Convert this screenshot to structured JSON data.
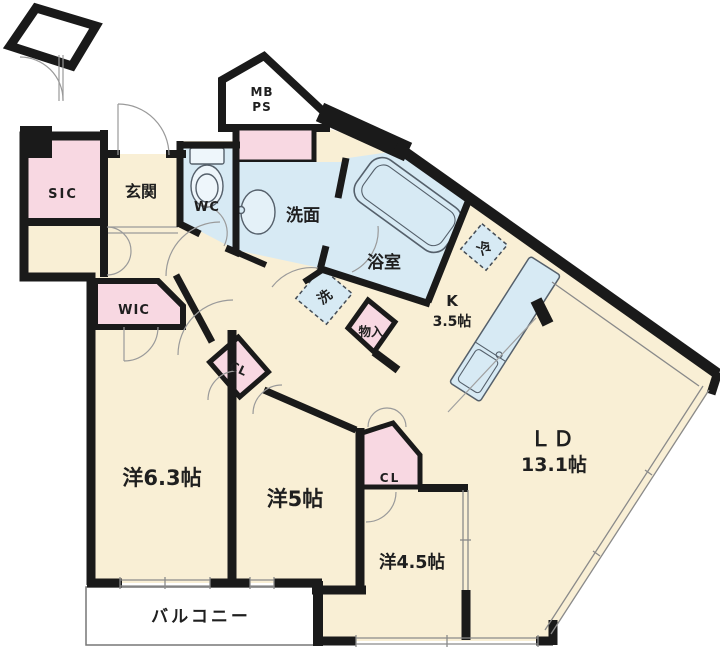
{
  "plan": {
    "type": "floor-plan",
    "rooms": {
      "sic": {
        "label": "SIC"
      },
      "genkan": {
        "label": "玄関"
      },
      "wc": {
        "label": "WC"
      },
      "mbps": {
        "label_line1": "MB",
        "label_line2": "PS"
      },
      "senmen": {
        "label": "洗面"
      },
      "bathroom": {
        "label": "浴室"
      },
      "washer": {
        "label": "洗"
      },
      "monoire": {
        "label": "物入"
      },
      "fridge": {
        "label": "冷"
      },
      "kitchen": {
        "label_line1": "K",
        "label_line2": "3.5帖"
      },
      "living": {
        "label_line1": "ＬＤ",
        "label_line2": "13.1帖"
      },
      "wic": {
        "label": "WIC"
      },
      "cl_hall": {
        "label": "CL"
      },
      "cl_bed": {
        "label": "CL"
      },
      "bedroom1": {
        "label": "洋6.3帖"
      },
      "bedroom2": {
        "label": "洋5帖"
      },
      "bedroom3": {
        "label": "洋4.5帖"
      },
      "balcony": {
        "label": "バルコニー"
      }
    },
    "colors": {
      "floor": "#f9efd5",
      "closet": "#f8d8e2",
      "wet_area": "#d7eaf4",
      "wall": "#1a1a1a",
      "balcony": "#ffffff"
    }
  }
}
